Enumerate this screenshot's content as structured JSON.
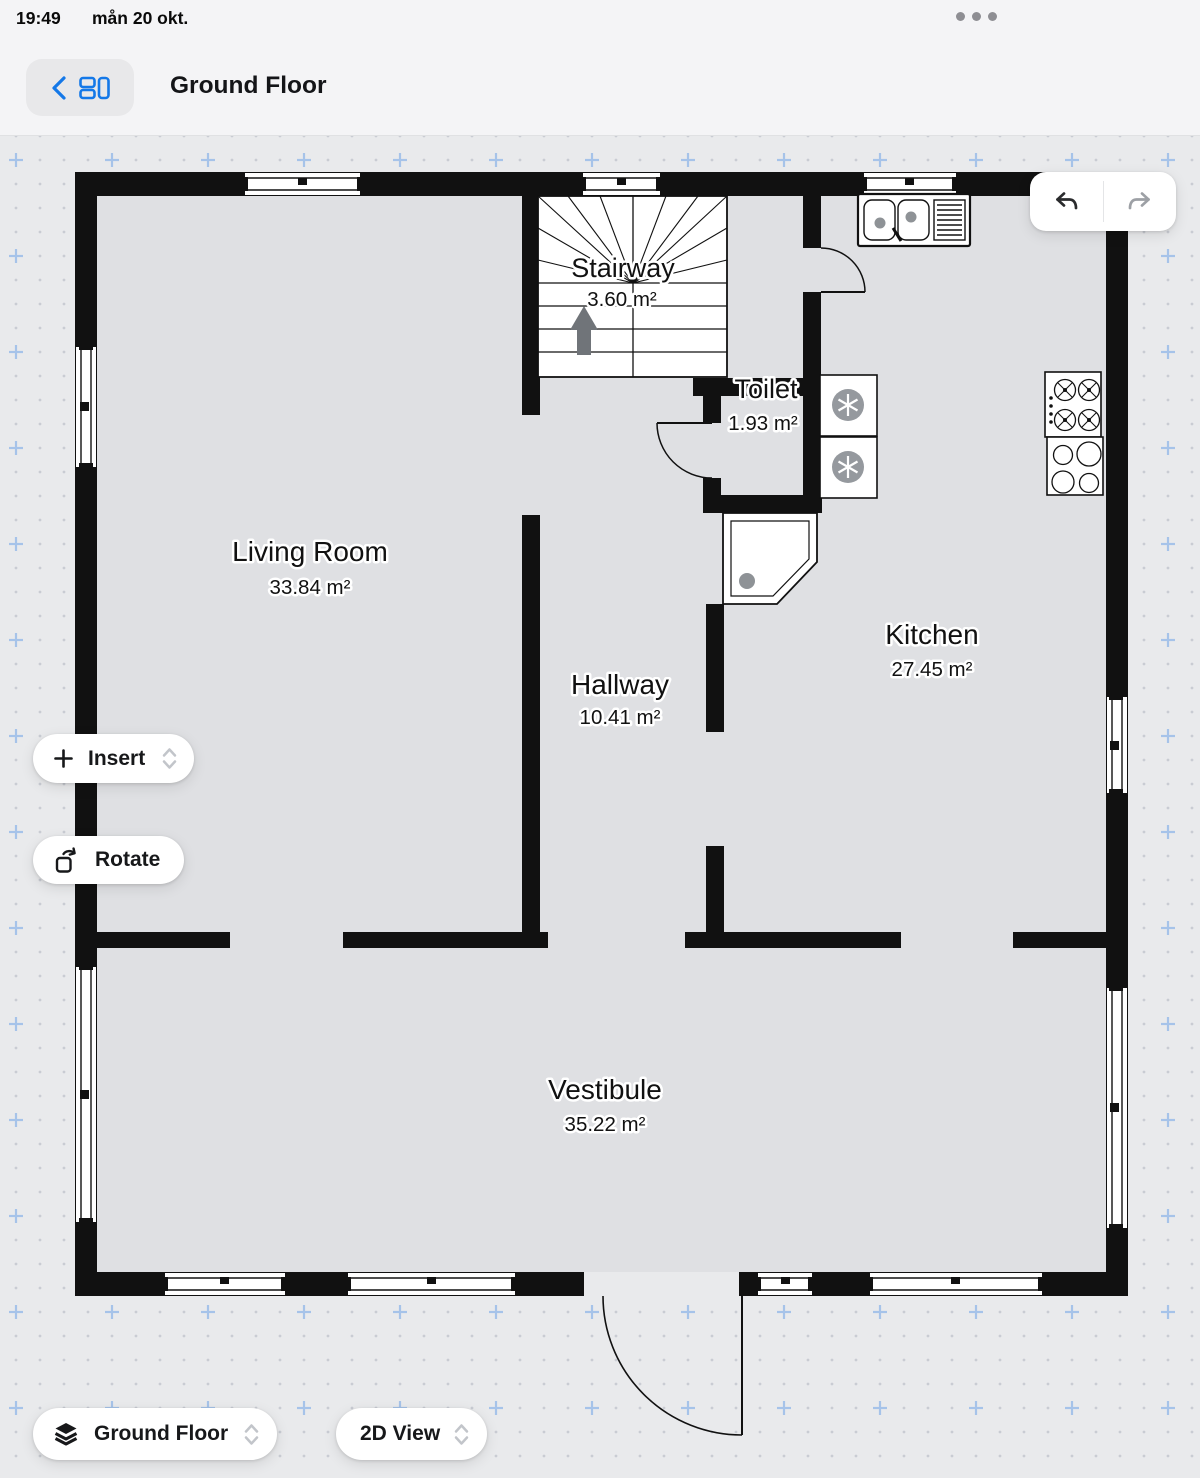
{
  "status_bar": {
    "time": "19:49",
    "date": "mån 20 okt."
  },
  "header": {
    "title": "Ground Floor"
  },
  "tools": {
    "insert": "Insert",
    "rotate": "Rotate"
  },
  "bottom_bar": {
    "floor_selector": "Ground Floor",
    "view_selector": "2D View"
  },
  "rooms": {
    "stairway": {
      "name": "Stairway",
      "area": "3.60 m²"
    },
    "toilet": {
      "name": "Toilet",
      "area": "1.93 m²"
    },
    "living_room": {
      "name": "Living Room",
      "area": "33.84 m²"
    },
    "hallway": {
      "name": "Hallway",
      "area": "10.41 m²"
    },
    "kitchen": {
      "name": "Kitchen",
      "area": "27.45 m²"
    },
    "vestibule": {
      "name": "Vestibule",
      "area": "35.22 m²"
    }
  },
  "colors": {
    "accent_blue": "#1478e8",
    "grid_plus": "#a6c3e9",
    "wall": "#111111",
    "floor_fill": "#dfe0e3",
    "canvas_bg": "#e9eaec",
    "disabled_gray": "#9da0a5"
  }
}
